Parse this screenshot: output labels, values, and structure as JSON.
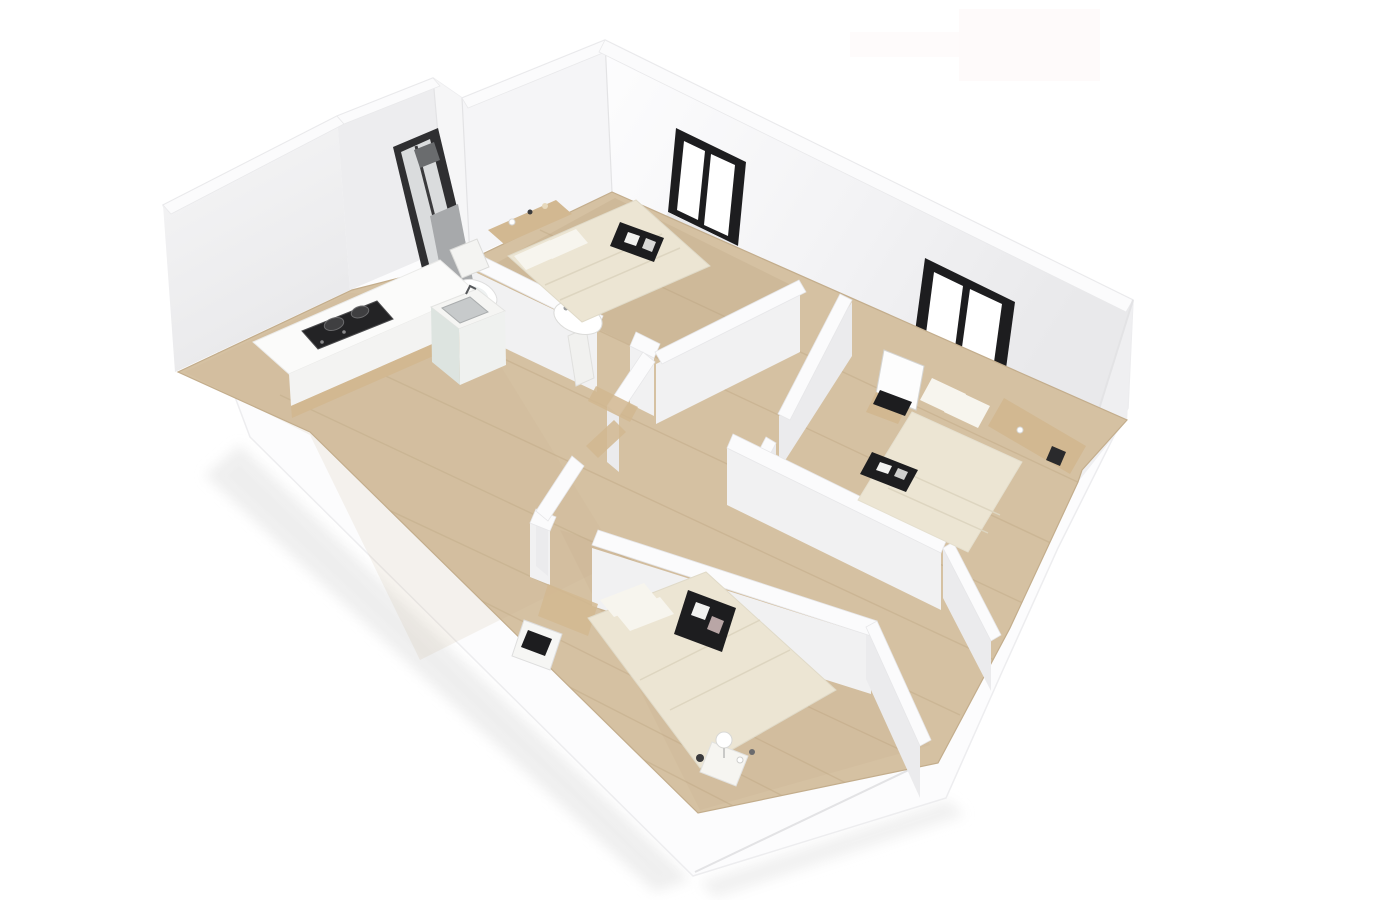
{
  "scene": {
    "type": "3d-isometric-apartment-floor-plan-render",
    "rooms": [
      {
        "name": "bathroom",
        "fixtures": [
          "shower-column",
          "toilet",
          "pedestal-sink"
        ]
      },
      {
        "name": "kitchen",
        "fixtures": [
          "l-shaped-counter",
          "gas-cooktop",
          "sink-cabinet"
        ]
      },
      {
        "name": "living-area",
        "fixtures": []
      },
      {
        "name": "bedroom-top",
        "fixtures": [
          "double-bed",
          "pillows",
          "dark-art-frame",
          "headboard-shelf",
          "window"
        ]
      },
      {
        "name": "bedroom-right",
        "fixtures": [
          "double-bed",
          "pillows",
          "dark-tray",
          "vanity-mirror",
          "stool",
          "laptop",
          "side-shelf",
          "window"
        ]
      },
      {
        "name": "bedroom-bottom",
        "fixtures": [
          "double-bed",
          "pillows",
          "dark-art-frame",
          "desk",
          "nightstand",
          "table-lamp"
        ]
      },
      {
        "name": "hallway",
        "fixtures": []
      }
    ],
    "window_count": 2,
    "floor_material": "light-wood"
  },
  "palette": {
    "background": "#ffffff",
    "artifact_tint": "#fdf8f8",
    "shadow": "#ebebeb",
    "silhouette": "#fcfcfd",
    "wall_face": "#f1f1f2",
    "wall_face_dark": "#ebebed",
    "wall_ridge": "#fbfbfc",
    "wall_edge": "#e4e4e6",
    "floor_wood": "#d5c1a2",
    "floor_line": "#c2ab88",
    "frame_dark": "#1d1d1f",
    "glass_white": "#ffffff",
    "bed_cream": "#ece5d3",
    "bed_white": "#f7f5ee",
    "wood_tan": "#d2b891",
    "counter_white": "#fbfbfa",
    "steel": "#c7cacb",
    "cooktop_dark": "#232325",
    "metal_gray": "#a7a9ab",
    "mint_panel": "#dde4e0"
  }
}
